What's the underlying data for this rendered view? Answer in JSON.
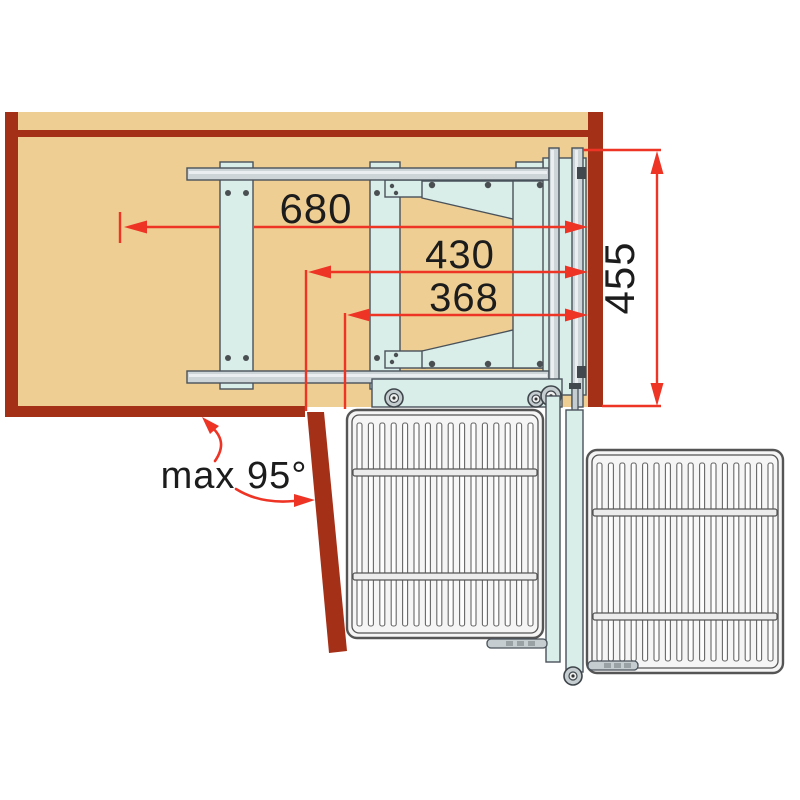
{
  "labels": {
    "depth_total": "680",
    "door_pivot_depth": "430",
    "rear_pivot_depth": "368",
    "front_height": "455",
    "max_opening_angle": "max 95°"
  },
  "colors": {
    "background": "#ffffff",
    "cabinet_wood": "#efce93",
    "cabinet_panel": "#a53018",
    "mechanism_fill": "#d9ede9",
    "rail_fill": "#cdd5d9",
    "dimension_red": "#ee3425",
    "label_text": "#1c1c1c"
  }
}
